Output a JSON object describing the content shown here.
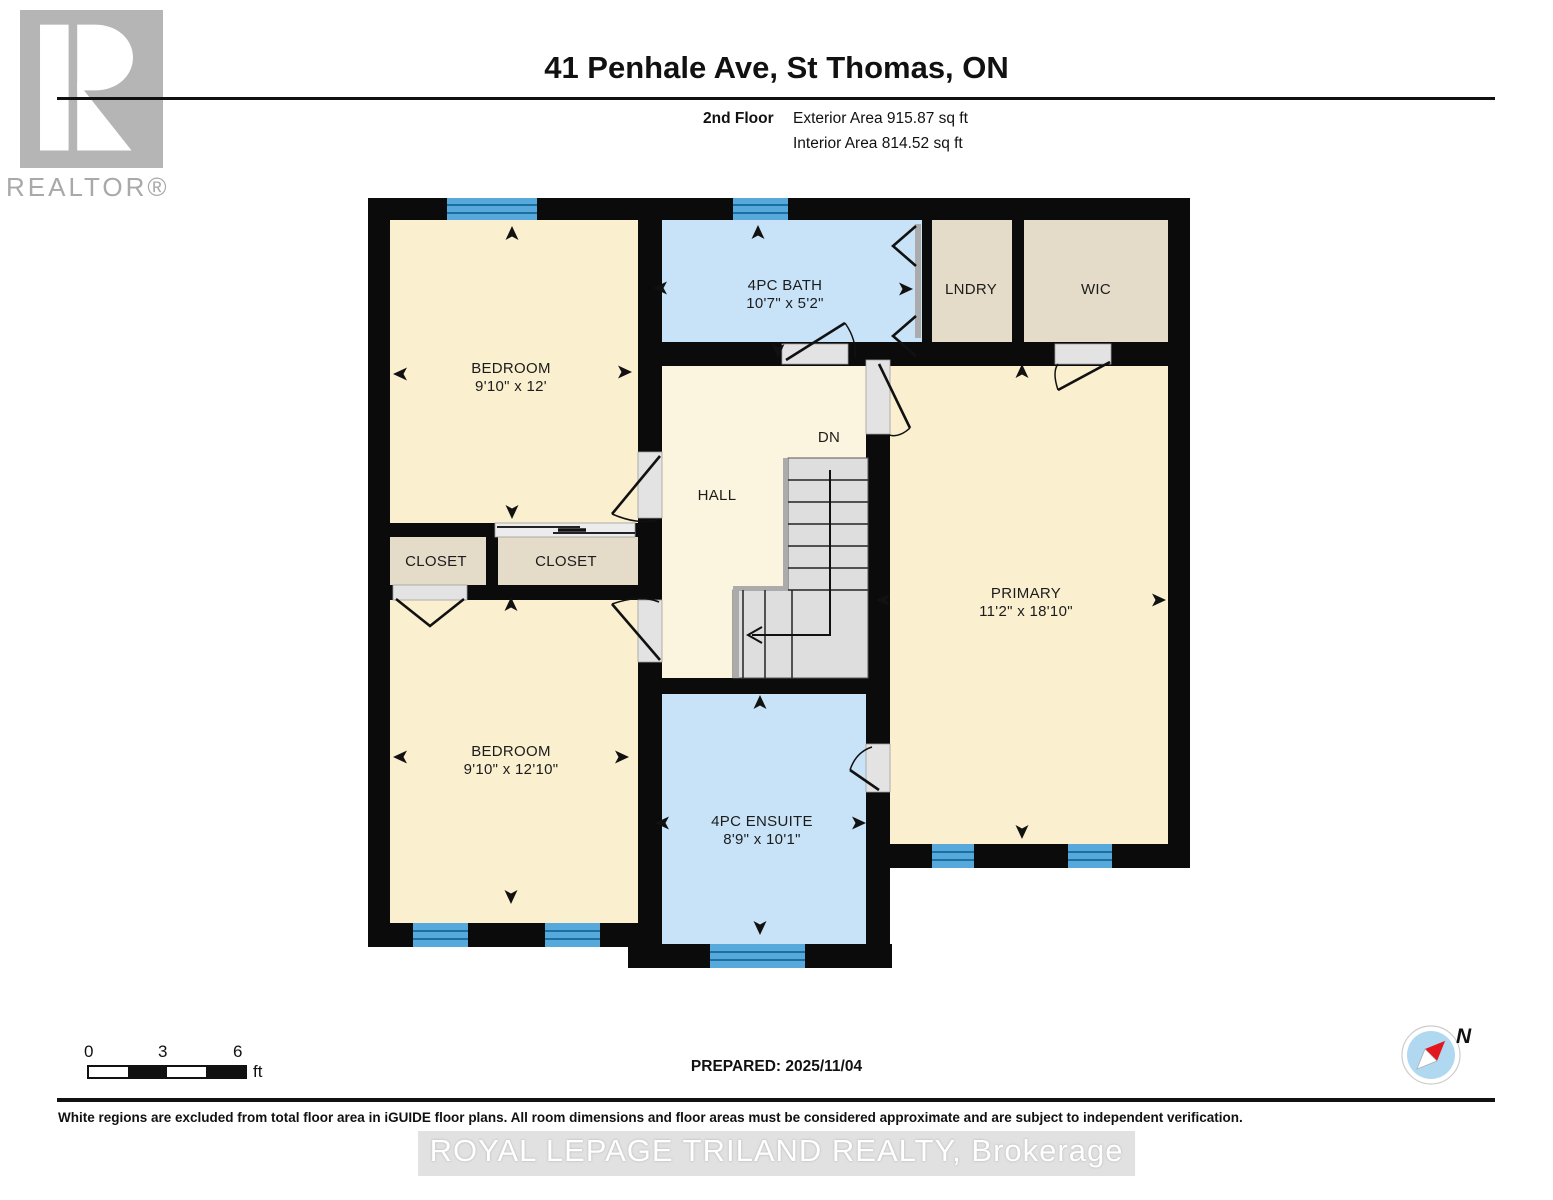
{
  "branding": {
    "realtor_logo_letter": "R",
    "realtor_label": "REALTOR®"
  },
  "header": {
    "title": "41 Penhale Ave, St Thomas, ON",
    "floor_label": "2nd Floor",
    "exterior_area": "Exterior Area 915.87 sq ft",
    "interior_area": "Interior Area 814.52 sq ft"
  },
  "rooms": {
    "bedroom_top": {
      "name": "BEDROOM",
      "dims": "9'10\" x 12'"
    },
    "bath": {
      "name": "4PC BATH",
      "dims": "10'7\" x 5'2\""
    },
    "laundry": {
      "name": "LNDRY"
    },
    "wic": {
      "name": "WIC"
    },
    "hall": {
      "name": "HALL"
    },
    "stairs": {
      "down_label": "DN"
    },
    "primary": {
      "name": "PRIMARY",
      "dims": "11'2\" x 18'10\""
    },
    "closet_left": {
      "name": "CLOSET"
    },
    "closet_right": {
      "name": "CLOSET"
    },
    "bedroom_bottom": {
      "name": "BEDROOM",
      "dims": "9'10\" x 12'10\""
    },
    "ensuite": {
      "name": "4PC ENSUITE",
      "dims": "8'9\" x 10'1\""
    }
  },
  "scale_bar": {
    "tick_0": "0",
    "tick_3": "3",
    "tick_6": "6",
    "unit": "ft"
  },
  "prepared_label": "PREPARED: 2025/11/04",
  "compass": {
    "north_label": "N"
  },
  "watermark": "ROYAL LEPAGE TRILAND REALTY, Brokerage",
  "disclaimer": "White regions are excluded from total floor area in iGUIDE floor plans. All room dimensions and floor areas must be considered approximate and are subject to independent verification.",
  "colors": {
    "room": "#FAEFCF",
    "hall": "#FBF4DE",
    "wet": "#C8E3F8",
    "storage": "#E4DBC8",
    "window": "#57A9DC",
    "wall": "#0B0B0B",
    "stair": "#DEDEDE"
  }
}
